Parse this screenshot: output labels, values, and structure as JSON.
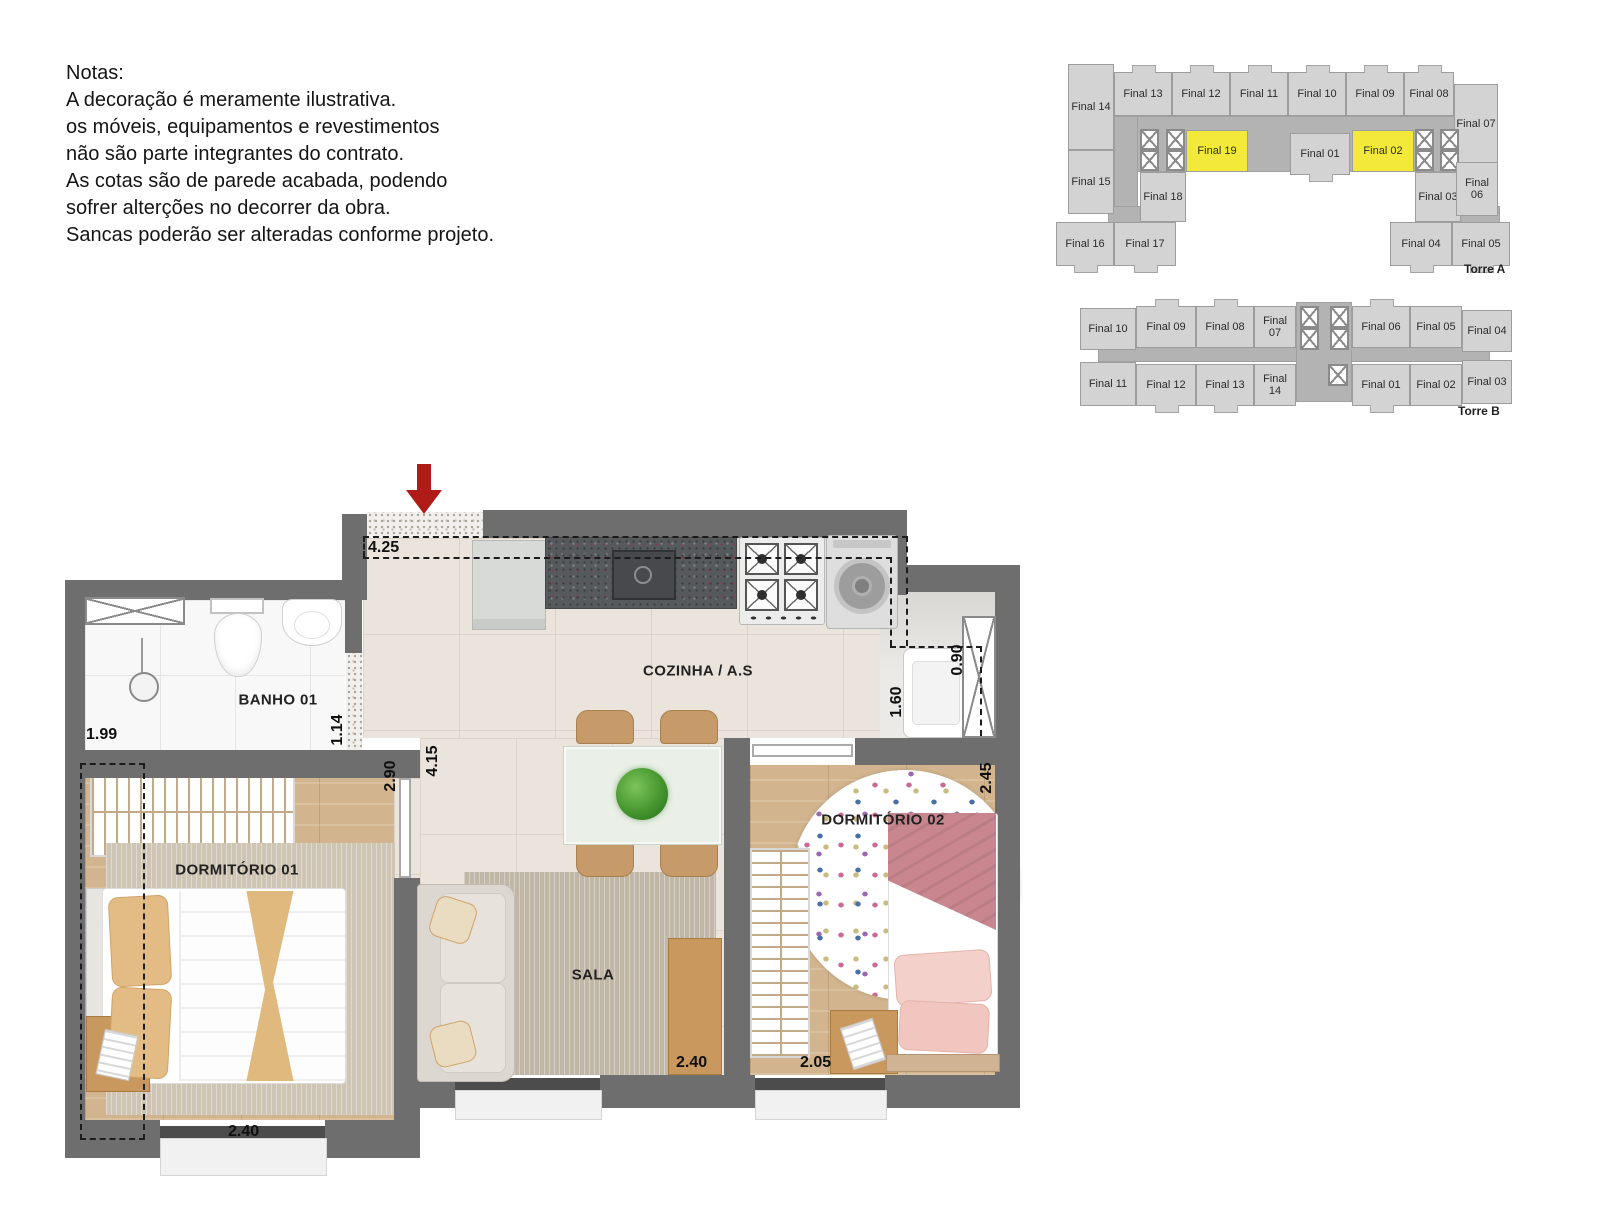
{
  "notes": {
    "title": "Notas:",
    "lines": [
      "A decoração é meramente ilustrativa.",
      "os móveis, equipamentos e revestimentos",
      "não são parte integrantes do contrato.",
      "As cotas são de parede acabada, podendo",
      "sofrer alterções no decorrer da obra.",
      "Sancas poderão ser alteradas conforme projeto."
    ]
  },
  "colors": {
    "wall": "#6e6e6e",
    "unit_fill": "#d3d3d3",
    "corridor_fill": "#b3b3b3",
    "highlight_fill": "#f2e93a",
    "arrow_red": "#b01b18"
  },
  "floor_plan": {
    "room_labels": [
      {
        "text": "BANHO 01",
        "x": 278,
        "y": 700
      },
      {
        "text": "COZINHA / A.S",
        "x": 698,
        "y": 671
      },
      {
        "text": "DORMITÓRIO 01",
        "x": 237,
        "y": 870
      },
      {
        "text": "SALA",
        "x": 593,
        "y": 975
      },
      {
        "text": "DORMITÓRIO 02",
        "x": 883,
        "y": 820
      }
    ],
    "dimensions": [
      {
        "text": "4.25",
        "x": 368,
        "y": 539,
        "rot": 0
      },
      {
        "text": "1.99",
        "x": 86,
        "y": 726,
        "rot": 0
      },
      {
        "text": "1.14",
        "x": 316,
        "y": 721,
        "rot": 1
      },
      {
        "text": "2.90",
        "x": 369,
        "y": 767,
        "rot": 1
      },
      {
        "text": "4.15",
        "x": 411,
        "y": 752,
        "rot": 1
      },
      {
        "text": "1.60",
        "x": 875,
        "y": 693,
        "rot": 1
      },
      {
        "text": "0.90",
        "x": 936,
        "y": 651,
        "rot": 1
      },
      {
        "text": "2.45",
        "x": 965,
        "y": 769,
        "rot": 1
      },
      {
        "text": "2.40",
        "x": 228,
        "y": 1123,
        "rot": 0
      },
      {
        "text": "2.40",
        "x": 676,
        "y": 1054,
        "rot": 0
      },
      {
        "text": "2.05",
        "x": 800,
        "y": 1054,
        "rot": 0
      }
    ]
  },
  "towers": [
    {
      "name": "Torre A",
      "name_x": 1464,
      "name_y": 262,
      "pieces": [
        {
          "t": "c",
          "x": 1114,
          "y": 116,
          "w": 348,
          "h": 56
        },
        {
          "t": "c",
          "x": 1114,
          "y": 116,
          "w": 24,
          "h": 106
        },
        {
          "t": "c",
          "x": 1462,
          "y": 116,
          "w": 24,
          "h": 106
        },
        {
          "t": "c",
          "x": 1108,
          "y": 206,
          "w": 48,
          "h": 18
        },
        {
          "t": "c",
          "x": 1452,
          "y": 206,
          "w": 48,
          "h": 18
        },
        {
          "t": "u",
          "x": 1068,
          "y": 64,
          "w": 46,
          "h": 86,
          "label": "Final 14"
        },
        {
          "t": "u",
          "x": 1114,
          "y": 72,
          "w": 58,
          "h": 44,
          "label": "Final 13",
          "tab": "t"
        },
        {
          "t": "u",
          "x": 1172,
          "y": 72,
          "w": 58,
          "h": 44,
          "label": "Final 12",
          "tab": "t"
        },
        {
          "t": "u",
          "x": 1230,
          "y": 72,
          "w": 58,
          "h": 44,
          "label": "Final 11",
          "tab": "t"
        },
        {
          "t": "u",
          "x": 1288,
          "y": 72,
          "w": 58,
          "h": 44,
          "label": "Final 10",
          "tab": "t"
        },
        {
          "t": "u",
          "x": 1346,
          "y": 72,
          "w": 58,
          "h": 44,
          "label": "Final 09",
          "tab": "t"
        },
        {
          "t": "u",
          "x": 1404,
          "y": 72,
          "w": 50,
          "h": 44,
          "label": "Final 08",
          "tab": "t"
        },
        {
          "t": "u",
          "x": 1454,
          "y": 84,
          "w": 44,
          "h": 80,
          "label": "Final 07"
        },
        {
          "t": "h",
          "x": 1186,
          "y": 130,
          "w": 62,
          "h": 42,
          "label": "Final 19"
        },
        {
          "t": "u",
          "x": 1290,
          "y": 133,
          "w": 60,
          "h": 42,
          "label": "Final 01",
          "tab": "b"
        },
        {
          "t": "h",
          "x": 1352,
          "y": 130,
          "w": 62,
          "h": 42,
          "label": "Final 02"
        },
        {
          "t": "x",
          "x": 1140,
          "y": 129,
          "w": 19,
          "h": 21
        },
        {
          "t": "x",
          "x": 1140,
          "y": 150,
          "w": 19,
          "h": 21
        },
        {
          "t": "x",
          "x": 1166,
          "y": 129,
          "w": 19,
          "h": 21
        },
        {
          "t": "x",
          "x": 1166,
          "y": 150,
          "w": 19,
          "h": 21
        },
        {
          "t": "x",
          "x": 1415,
          "y": 129,
          "w": 19,
          "h": 21
        },
        {
          "t": "x",
          "x": 1415,
          "y": 150,
          "w": 19,
          "h": 21
        },
        {
          "t": "x",
          "x": 1440,
          "y": 129,
          "w": 19,
          "h": 21
        },
        {
          "t": "x",
          "x": 1440,
          "y": 150,
          "w": 19,
          "h": 21
        },
        {
          "t": "u",
          "x": 1068,
          "y": 150,
          "w": 46,
          "h": 64,
          "label": "Final 15"
        },
        {
          "t": "u",
          "x": 1140,
          "y": 172,
          "w": 46,
          "h": 50,
          "label": "Final 18"
        },
        {
          "t": "u",
          "x": 1415,
          "y": 172,
          "w": 46,
          "h": 50,
          "label": "Final 03"
        },
        {
          "t": "u",
          "x": 1456,
          "y": 162,
          "w": 42,
          "h": 54,
          "label": "Final 06"
        },
        {
          "t": "u",
          "x": 1056,
          "y": 222,
          "w": 58,
          "h": 44,
          "label": "Final 16",
          "tab": "b"
        },
        {
          "t": "u",
          "x": 1114,
          "y": 222,
          "w": 62,
          "h": 44,
          "label": "Final 17",
          "tab": "b"
        },
        {
          "t": "u",
          "x": 1390,
          "y": 222,
          "w": 62,
          "h": 44,
          "label": "Final 04",
          "tab": "b"
        },
        {
          "t": "u",
          "x": 1452,
          "y": 222,
          "w": 58,
          "h": 44,
          "label": "Final 05",
          "tab": "b"
        }
      ]
    },
    {
      "name": "Torre B",
      "name_x": 1458,
      "name_y": 404,
      "pieces": [
        {
          "t": "c",
          "x": 1098,
          "y": 344,
          "w": 392,
          "h": 18
        },
        {
          "t": "c",
          "x": 1296,
          "y": 302,
          "w": 56,
          "h": 100
        },
        {
          "t": "u",
          "x": 1080,
          "y": 308,
          "w": 56,
          "h": 42,
          "label": "Final 10"
        },
        {
          "t": "u",
          "x": 1136,
          "y": 306,
          "w": 60,
          "h": 42,
          "label": "Final 09",
          "tab": "t"
        },
        {
          "t": "u",
          "x": 1196,
          "y": 306,
          "w": 58,
          "h": 42,
          "label": "Final 08",
          "tab": "t"
        },
        {
          "t": "u",
          "x": 1254,
          "y": 306,
          "w": 42,
          "h": 42,
          "label": "Final 07"
        },
        {
          "t": "u",
          "x": 1352,
          "y": 306,
          "w": 58,
          "h": 42,
          "label": "Final 06",
          "tab": "t"
        },
        {
          "t": "u",
          "x": 1410,
          "y": 306,
          "w": 52,
          "h": 42,
          "label": "Final 05"
        },
        {
          "t": "u",
          "x": 1462,
          "y": 310,
          "w": 50,
          "h": 42,
          "label": "Final 04"
        },
        {
          "t": "u",
          "x": 1080,
          "y": 362,
          "w": 56,
          "h": 44,
          "label": "Final 11"
        },
        {
          "t": "u",
          "x": 1136,
          "y": 364,
          "w": 60,
          "h": 42,
          "label": "Final 12",
          "tab": "b"
        },
        {
          "t": "u",
          "x": 1196,
          "y": 364,
          "w": 58,
          "h": 42,
          "label": "Final 13",
          "tab": "b"
        },
        {
          "t": "u",
          "x": 1254,
          "y": 364,
          "w": 42,
          "h": 42,
          "label": "Final 14"
        },
        {
          "t": "u",
          "x": 1352,
          "y": 364,
          "w": 58,
          "h": 42,
          "label": "Final 01",
          "tab": "b"
        },
        {
          "t": "u",
          "x": 1410,
          "y": 364,
          "w": 52,
          "h": 42,
          "label": "Final 02"
        },
        {
          "t": "u",
          "x": 1462,
          "y": 360,
          "w": 50,
          "h": 44,
          "label": "Final 03"
        },
        {
          "t": "x",
          "x": 1300,
          "y": 306,
          "w": 19,
          "h": 22
        },
        {
          "t": "x",
          "x": 1300,
          "y": 328,
          "w": 19,
          "h": 22
        },
        {
          "t": "x",
          "x": 1330,
          "y": 306,
          "w": 19,
          "h": 22
        },
        {
          "t": "x",
          "x": 1330,
          "y": 328,
          "w": 19,
          "h": 22
        },
        {
          "t": "x",
          "x": 1328,
          "y": 364,
          "w": 20,
          "h": 22
        }
      ]
    }
  ]
}
